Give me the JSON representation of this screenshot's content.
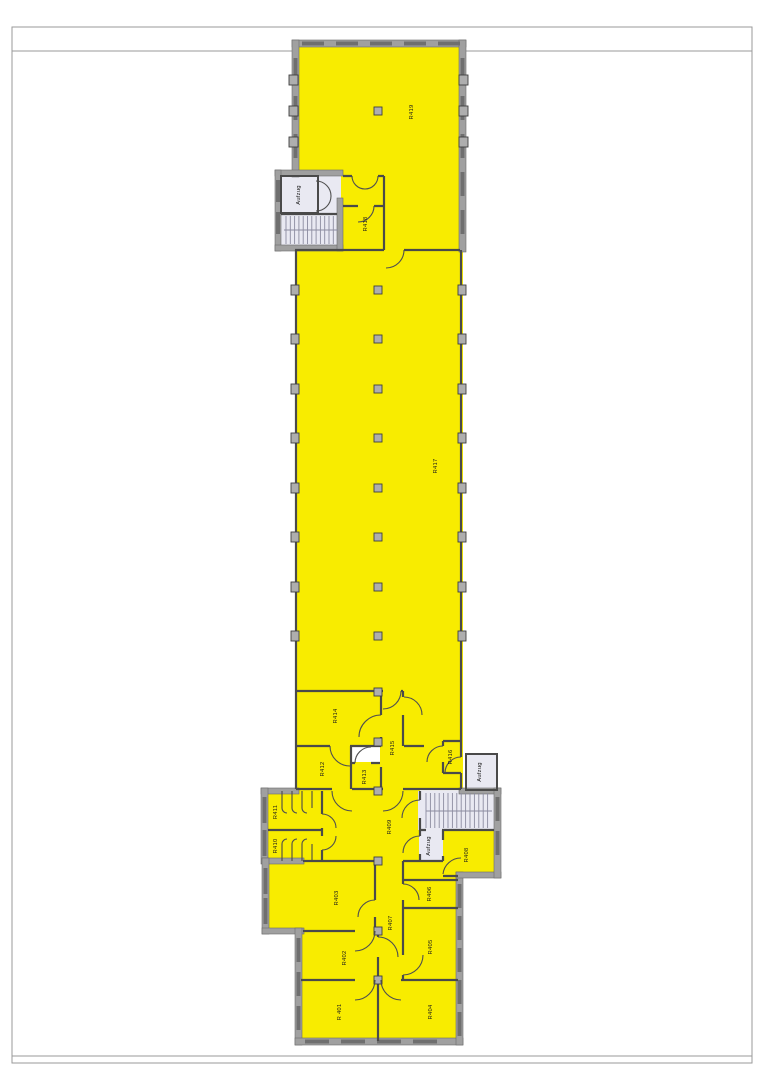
{
  "drawing": {
    "kind": "floor-plan",
    "floor_prefix": "R4"
  },
  "palette": {
    "room_fill": "#f8ec00",
    "service_fill": "#e9e9f2",
    "wall_gray": "#a0a0a0",
    "wall_dark": "#4a4a4a",
    "window_gray": "#6f6f6f",
    "label_color": "#1b1b1b",
    "sheet_bg": "#ffffff"
  },
  "rooms": {
    "r401": "R 401",
    "r402": "R402",
    "r403": "R403",
    "r404": "R404",
    "r405": "R405",
    "r406": "R406",
    "r407": "R407",
    "r408": "R408",
    "r409": "R409",
    "r410": "R410",
    "r411": "R411",
    "r412": "R412",
    "r413": "R413",
    "r414": "R414",
    "r415": "R415",
    "r416": "R416",
    "r417": "R417",
    "r418": "R418",
    "r419": "R419",
    "aufzug_top": "Aufzug",
    "aufzug_east": "Aufzug",
    "aufzug_mid": "Aufzug"
  }
}
